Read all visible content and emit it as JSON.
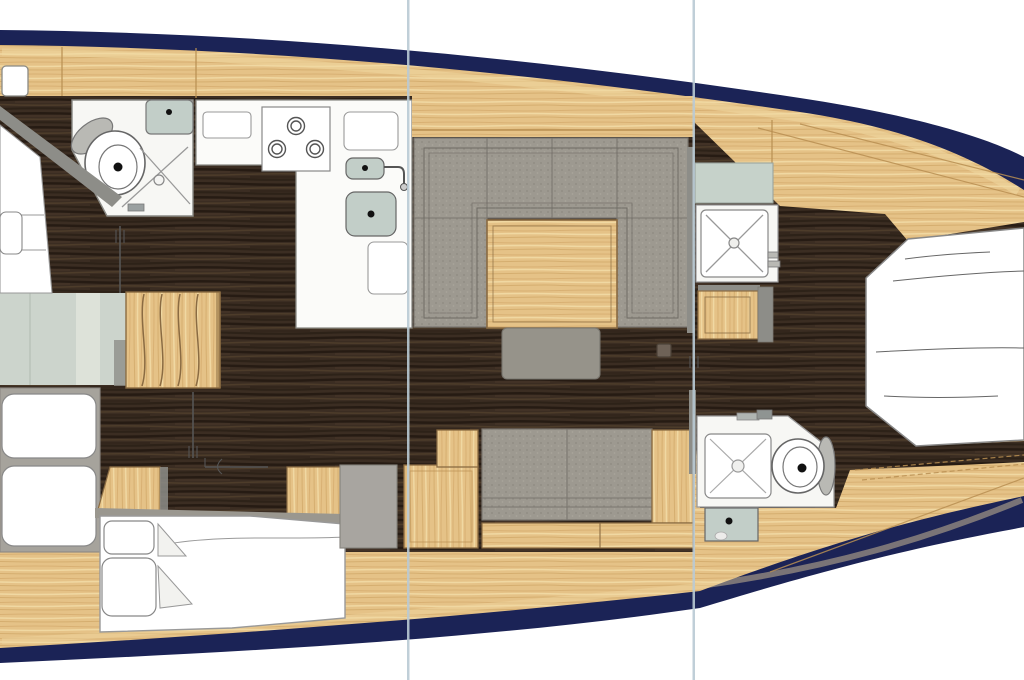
{
  "figure": {
    "type": "yacht-interior-floor-plan",
    "view": "overhead",
    "orientation": "bow-right",
    "canvas": {
      "width": 1024,
      "height": 680
    }
  },
  "palette": {
    "page_bg": "#ffffff",
    "hull": "#1b2356",
    "deck": "#e5c287",
    "deck_light": "#f0d8a0",
    "deck_seam": "#b98f52",
    "walnut": "#3b2d22",
    "walnut_dark": "#241a12",
    "walnut_light": "#51402c",
    "fixture_white": "#ffffff",
    "room_white": "#f7f7f4",
    "outline": "#8a8a85",
    "outline_dark": "#555555",
    "sage": "#ccd4cc",
    "sage_light": "#dde2d9",
    "counter_sage": "#c6d2ca",
    "basin": "#c2cec8",
    "upholstery": "#9d9990",
    "upholstery_dark": "#96938a",
    "upholstery_line": "#7a766f",
    "gray_cabinet": "#a8a5a0",
    "berth_gray": "#a6a39c",
    "wall_gray": "#8d8d88",
    "lid_gray": "#b9b9b4",
    "separator_line": "#b9cad4",
    "wood_edge": "#8a6b42"
  },
  "rooms": [
    {
      "id": "head-top-left",
      "fixtures": [
        "toilet",
        "toilet-lid",
        "shower-doors",
        "sink",
        "vanity-cabinet"
      ]
    },
    {
      "id": "galley",
      "fixtures": [
        "three-burner-stove",
        "small-basin",
        "large-basin",
        "faucet",
        "counter-items"
      ]
    },
    {
      "id": "salon-dinette",
      "fixtures": [
        "u-shaped-sofa",
        "wood-table",
        "ottoman",
        "instrument-box"
      ]
    },
    {
      "id": "companionway",
      "fixtures": [
        "wood-steps",
        "passage-floor",
        "doors"
      ]
    },
    {
      "id": "cabin-bottom-left",
      "fixtures": [
        "side-berth",
        "pillows",
        "double-bed",
        "nightstand",
        "wood-locker"
      ]
    },
    {
      "id": "shower-room-top-right",
      "fixtures": [
        "shower-stall",
        "sage-counter",
        "wood-seat"
      ]
    },
    {
      "id": "head-bottom-right",
      "fixtures": [
        "shower-pan",
        "toilet",
        "toilet-lid",
        "sink",
        "faucet"
      ]
    },
    {
      "id": "bow-berth-right",
      "fixtures": [
        "double-berth",
        "sheet-lines"
      ]
    },
    {
      "id": "settee-bottom-center",
      "fixtures": [
        "sofa",
        "wood-armrest",
        "gray-cabinet",
        "wood-cabinet",
        "base-step"
      ]
    }
  ],
  "separators": {
    "count": 2,
    "positions_x": [
      408,
      694
    ]
  }
}
